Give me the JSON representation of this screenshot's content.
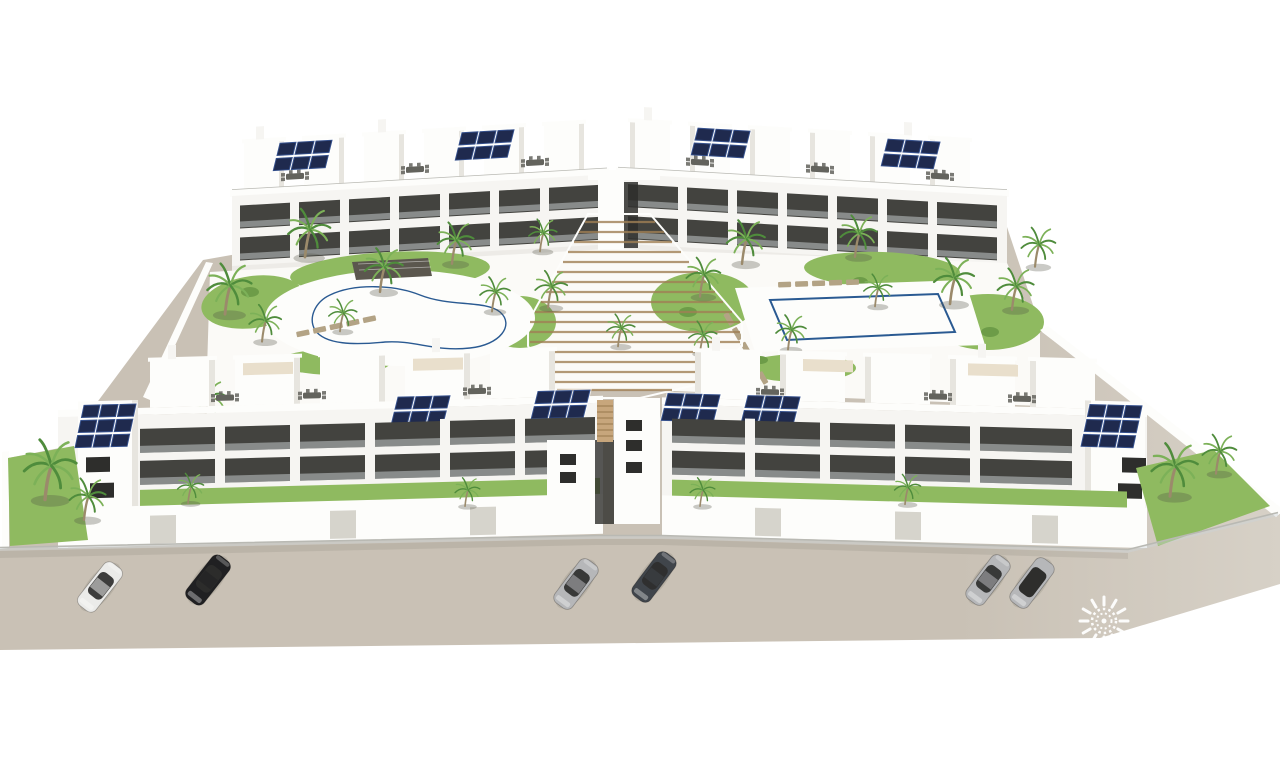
{
  "scene": {
    "description": "Aerial 3D architectural rendering of a white Mediterranean apartment complex: two rear residential blocks and two front residential blocks around a landscaped courtyard with a kidney-shaped pool, a rectangular pool, palm trees, a central timber amphitheater staircase, rooftop terraces with furniture and solar panels, private street-side gardens behind glass balustrades, and six cars parked on the beige street in front.",
    "render_style": "computer-generated architectural visualization on white background",
    "counts": {
      "residential_blocks": 4,
      "swimming_pools": 2,
      "parked_cars": 6,
      "palm_trees": 28,
      "rooftop_solar_arrays": 10
    },
    "objects": [
      "apartment buildings",
      "rooftop penthouse terraces",
      "solar panel arrays",
      "kidney-shaped swimming pool",
      "rectangular swimming pool",
      "pool pergola",
      "timber amphitheater stairs",
      "palm trees",
      "garden lawns",
      "sun loungers",
      "rooftop dining sets",
      "glass balustrade fence",
      "private garden walls",
      "parked cars",
      "street"
    ],
    "watermark": {
      "icon": "sun-logo-watermark-icon"
    }
  },
  "colors": {
    "bg": "#ffffff",
    "ground": "#c9c1b5",
    "ground_hi": "#d7d1c7",
    "deck": "#fbfaf7",
    "building": "#f6f5f2",
    "building_bright": "#fdfdfb",
    "shade": "#e7e5df",
    "shade2": "#d6d4cc",
    "opening": "#43433f",
    "glass": "#2e2e2c",
    "glassrail": "#cdd3d6",
    "railing": "#b9b9b3",
    "solar": "#1f2a4e",
    "solar_cell": "#35508c",
    "pool_deep": "#3772b4",
    "pool_mid": "#5e9cd2",
    "pool_light": "#a6d0ea",
    "pool_edge": "#2a5a92",
    "grass": "#8fba60",
    "grass_dark": "#6d9c48",
    "palm": "#4f8c3c",
    "palm_light": "#7cb158",
    "trunk": "#9b8a6b",
    "wood": "#c7a67c",
    "wood_dark": "#a08055",
    "pergola": "#5b574e",
    "furn_gray": "#63635d",
    "furn_tan": "#b3a385",
    "canopy": "#e9dfcc",
    "car_white": "#ebebe9",
    "car_black": "#202022",
    "car_silver": "#b6b7b9",
    "car_dark": "#40454b",
    "watermark": "#ffffff",
    "shadow": "rgba(80,78,66,0.30)"
  }
}
